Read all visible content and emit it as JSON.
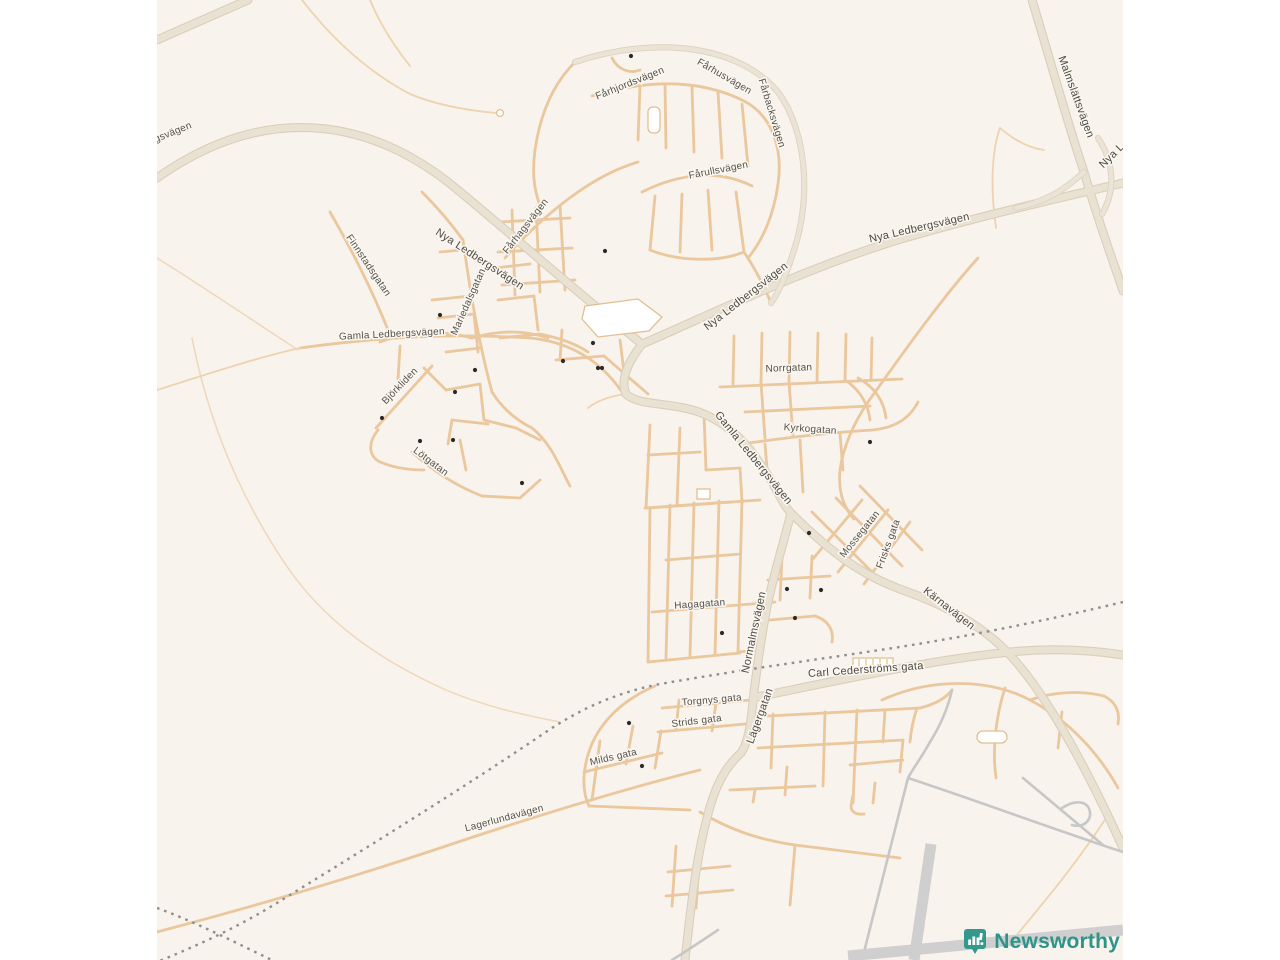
{
  "map": {
    "background_color": "#f8f3ec",
    "road_colors": {
      "minor_street": "#eac79d",
      "major_road_fill": "#e9e2d3",
      "major_road_casing": "#d9cfba",
      "airfield_gray": "#c7c7c7",
      "railway_dash": "#8f8f8f"
    },
    "street_labels": [
      {
        "text": "gsvägen",
        "x": 174,
        "y": 135,
        "rot": -22,
        "big": false
      },
      {
        "text": "Nya Ledbergsvägen",
        "x": 478,
        "y": 262,
        "rot": 33,
        "big": true
      },
      {
        "text": "Nya Ledbergsvägen",
        "x": 748,
        "y": 299,
        "rot": -38,
        "big": true
      },
      {
        "text": "Nya Ledbergsvägen",
        "x": 920,
        "y": 231,
        "rot": -13,
        "big": true
      },
      {
        "text": "Nya L",
        "x": 1114,
        "y": 158,
        "rot": -45,
        "big": true
      },
      {
        "text": "Malmslättsvägen",
        "x": 1073,
        "y": 98,
        "rot": 70,
        "big": true
      },
      {
        "text": "Fårhjordsvägen",
        "x": 631,
        "y": 86,
        "rot": -22,
        "big": false
      },
      {
        "text": "Fårhusvägen",
        "x": 723,
        "y": 79,
        "rot": 30,
        "big": false
      },
      {
        "text": "Fårbacksvägen",
        "x": 769,
        "y": 114,
        "rot": 73,
        "big": false
      },
      {
        "text": "Fårullsvägen",
        "x": 719,
        "y": 173,
        "rot": -11,
        "big": false
      },
      {
        "text": "Fårhagsvägen",
        "x": 528,
        "y": 228,
        "rot": -52,
        "big": false
      },
      {
        "text": "Finnstadsgatan",
        "x": 366,
        "y": 267,
        "rot": 56,
        "big": false
      },
      {
        "text": "Mariedalsgatan",
        "x": 471,
        "y": 303,
        "rot": -66,
        "big": false
      },
      {
        "text": "Gamla Ledbergsvägen",
        "x": 392,
        "y": 337,
        "rot": -3,
        "big": false
      },
      {
        "text": "Björkliden",
        "x": 402,
        "y": 388,
        "rot": -46,
        "big": false
      },
      {
        "text": "Lötgatan",
        "x": 429,
        "y": 464,
        "rot": 37,
        "big": false
      },
      {
        "text": "Norrgatan",
        "x": 789,
        "y": 371,
        "rot": -2,
        "big": false
      },
      {
        "text": "Kyrkogatan",
        "x": 810,
        "y": 432,
        "rot": 4,
        "big": false
      },
      {
        "text": "Gamla Ledbergsvägen",
        "x": 751,
        "y": 460,
        "rot": 51,
        "big": true
      },
      {
        "text": "Mossegatan",
        "x": 862,
        "y": 536,
        "rot": -51,
        "big": false
      },
      {
        "text": "Frisks gata",
        "x": 891,
        "y": 545,
        "rot": -70,
        "big": false
      },
      {
        "text": "Kärnavägen",
        "x": 947,
        "y": 611,
        "rot": 38,
        "big": true
      },
      {
        "text": "Hagagatan",
        "x": 700,
        "y": 607,
        "rot": -4,
        "big": false
      },
      {
        "text": "Normalmsvägen",
        "x": 757,
        "y": 633,
        "rot": -78,
        "big": true
      },
      {
        "text": "Carl Cederströms gata",
        "x": 866,
        "y": 673,
        "rot": -4,
        "big": true
      },
      {
        "text": "Torgnys gata",
        "x": 712,
        "y": 703,
        "rot": -5,
        "big": false
      },
      {
        "text": "Strids gata",
        "x": 697,
        "y": 724,
        "rot": -7,
        "big": false
      },
      {
        "text": "Milds gata",
        "x": 614,
        "y": 760,
        "rot": -13,
        "big": false
      },
      {
        "text": "Lägergatan",
        "x": 763,
        "y": 717,
        "rot": -70,
        "big": true
      },
      {
        "text": "Lagerlundavägen",
        "x": 505,
        "y": 821,
        "rot": -15,
        "big": false
      }
    ],
    "poi_dots": [
      [
        631,
        56
      ],
      [
        605,
        251
      ],
      [
        440,
        315
      ],
      [
        593,
        343
      ],
      [
        563,
        361
      ],
      [
        598,
        368
      ],
      [
        602,
        368
      ],
      [
        475,
        370
      ],
      [
        455,
        392
      ],
      [
        382,
        418
      ],
      [
        420,
        441
      ],
      [
        453,
        440
      ],
      [
        522,
        483
      ],
      [
        870,
        442
      ],
      [
        809,
        533
      ],
      [
        787,
        589
      ],
      [
        821,
        590
      ],
      [
        795,
        618
      ],
      [
        722,
        633
      ],
      [
        629,
        723
      ],
      [
        642,
        766
      ]
    ],
    "attribution": {
      "brand": "Newsworthy",
      "icon": "newsworthy-bar-chart-bubble-icon",
      "icon_color": "#35988c",
      "text_color": "#2d9489"
    }
  }
}
